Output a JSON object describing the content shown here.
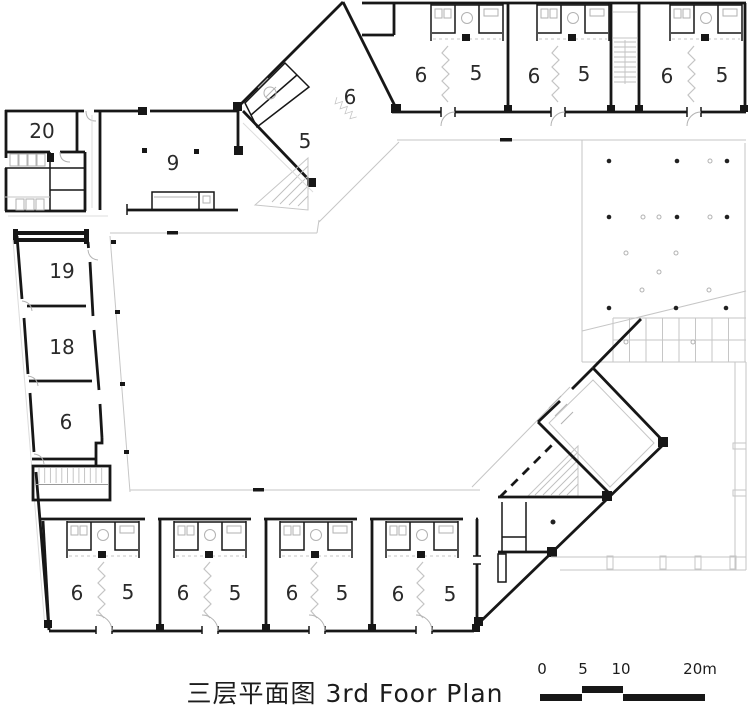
{
  "title": {
    "text": "三层平面图 3rd Foor Plan"
  },
  "scale_bar": {
    "labels": [
      "0",
      "5",
      "10",
      "20m"
    ]
  },
  "rooms": [
    {
      "label": "20",
      "x": 42,
      "y": 138
    },
    {
      "label": "9",
      "x": 173,
      "y": 170
    },
    {
      "label": "6",
      "x": 350,
      "y": 104
    },
    {
      "label": "5",
      "x": 305,
      "y": 148
    },
    {
      "label": "6",
      "x": 421,
      "y": 82
    },
    {
      "label": "5",
      "x": 476,
      "y": 80
    },
    {
      "label": "6",
      "x": 534,
      "y": 83
    },
    {
      "label": "5",
      "x": 584,
      "y": 81
    },
    {
      "label": "6",
      "x": 667,
      "y": 83
    },
    {
      "label": "5",
      "x": 722,
      "y": 82
    },
    {
      "label": "19",
      "x": 62,
      "y": 278
    },
    {
      "label": "18",
      "x": 62,
      "y": 354
    },
    {
      "label": "6",
      "x": 66,
      "y": 429
    },
    {
      "label": "6",
      "x": 77,
      "y": 600
    },
    {
      "label": "5",
      "x": 128,
      "y": 599
    },
    {
      "label": "6",
      "x": 183,
      "y": 600
    },
    {
      "label": "5",
      "x": 235,
      "y": 600
    },
    {
      "label": "6",
      "x": 292,
      "y": 600
    },
    {
      "label": "5",
      "x": 342,
      "y": 600
    },
    {
      "label": "6",
      "x": 398,
      "y": 601
    },
    {
      "label": "5",
      "x": 450,
      "y": 601
    }
  ],
  "colors": {
    "wall": "#171717",
    "line_light": "#c6c6c6",
    "label": "#2a2a2a"
  }
}
